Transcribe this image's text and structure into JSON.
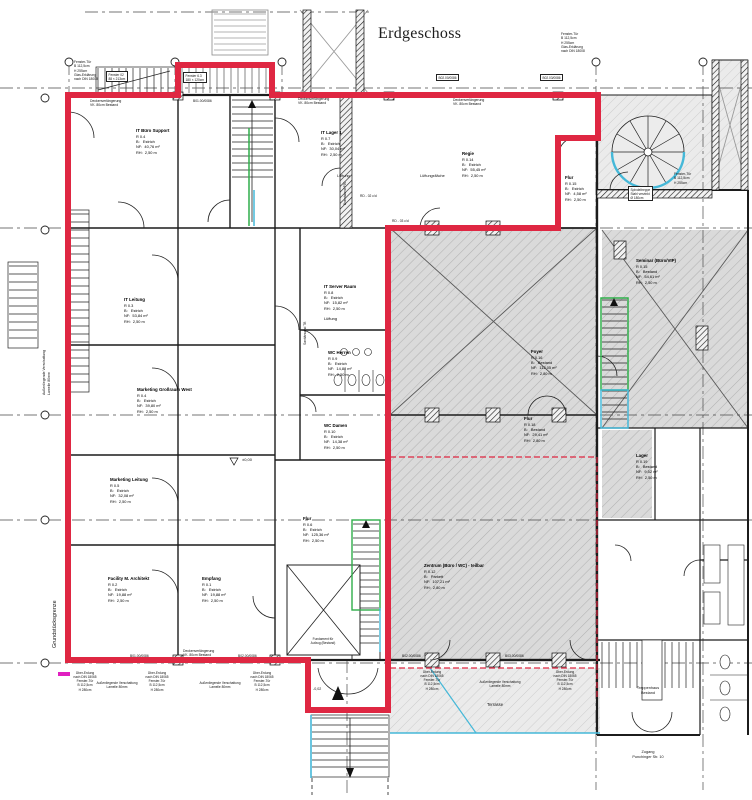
{
  "title": "Erdgeschoss",
  "colors": {
    "boundary_red": "#df2742",
    "hatch_gray": "#dadada",
    "accent_cyan": "#45b8d8",
    "accent_green": "#2fae4a",
    "accent_magenta": "#e020c0",
    "line_black": "#1c1c1c"
  },
  "rooms": [
    {
      "name": "IT Büro Support",
      "nr": "R 0.4",
      "b": "B:   Estrich",
      "nf": "NF:  40,76 m²",
      "rh": "RH:  2,50 m",
      "x": 136,
      "y": 128
    },
    {
      "name": "IT Lager 1",
      "nr": "R 0.7",
      "b": "B:   Estrich",
      "nf": "NF:  30,04 m²",
      "rh": "RH:  2,50 m",
      "x": 321,
      "y": 130
    },
    {
      "name": "Regie",
      "nr": "R 0.14",
      "b": "B:   Estrich",
      "nf": "NF:  55,45 m²",
      "rh": "RH:  2,50 m",
      "x": 462,
      "y": 151
    },
    {
      "name": "Flur",
      "nr": "R 0.15",
      "b": "B:   Estrich",
      "nf": "NF:  4,58 m²",
      "rh": "RH:  2,50 m",
      "x": 565,
      "y": 175
    },
    {
      "name": "IT Leitung",
      "nr": "R 0.3",
      "b": "B:   Estrich",
      "nf": "NF:  53,84 m²",
      "rh": "RH:  2,50 m",
      "x": 124,
      "y": 297
    },
    {
      "name": "IT Server Raum",
      "nr": "R 0.8",
      "b": "B:   Estrich",
      "nf": "NF:  15,82 m²",
      "rh": "RH:  2,50 m",
      "extra": "Lüftung",
      "x": 324,
      "y": 284
    },
    {
      "name": "WC Herren",
      "nr": "R 0.9",
      "b": "B:   Estrich",
      "nf": "NF:  14,88 m²",
      "rh": "RH:  2,50 m",
      "x": 328,
      "y": 350
    },
    {
      "name": "WC Damen",
      "nr": "R 0.10",
      "b": "B:   Estrich",
      "nf": "NF:  14,38 m²",
      "rh": "RH:  2,50 m",
      "x": 324,
      "y": 423
    },
    {
      "name": "Marketing Großraum West",
      "nr": "R 0.4",
      "b": "B:   Estrich",
      "nf": "NF:  39,80 m²",
      "rh": "RH:  2,50 m",
      "x": 137,
      "y": 387
    },
    {
      "name": "Marketing Leitung",
      "nr": "R 0.5",
      "b": "B:   Estrich",
      "nf": "NF:  32,08 m²",
      "rh": "RH:  2,50 m",
      "x": 110,
      "y": 477
    },
    {
      "name": "Flur",
      "nr": "R 0.6",
      "b": "B:   Estrich",
      "nf": "NF:  125,36 m²",
      "rh": "RH:  2,50 m",
      "x": 303,
      "y": 516
    },
    {
      "name": "Facility M. Architekt",
      "nr": "R 0.2",
      "b": "B:   Estrich",
      "nf": "NF:  19,88 m²",
      "rh": "RH:  2,50 m",
      "x": 108,
      "y": 576
    },
    {
      "name": "Empfang",
      "nr": "R 0.1",
      "b": "B:   Estrich",
      "nf": "NF:  19,88 m²",
      "rh": "RH:  2,50 m",
      "x": 202,
      "y": 576
    },
    {
      "name": "Foyer",
      "nr": "R 0.16",
      "b": "B:   Bestand",
      "nf": "NF:  112,05 m²",
      "rh": "RH:  2,80 m",
      "x": 531,
      "y": 349
    },
    {
      "name": "Flur",
      "nr": "R 0.18",
      "b": "B:   Bestand",
      "nf": "NF:  29,41 m²",
      "rh": "RH:  2,80 m",
      "x": 524,
      "y": 416
    },
    {
      "name": "Zentrum (Büro / WC) - teilbar",
      "nr": "R 0.12",
      "b": "B:   Parkett",
      "nf": "NF:  107,21 m²",
      "rh": "RH:  2,80 m",
      "x": 424,
      "y": 563
    },
    {
      "name": "Seminar (Büro/VIP)",
      "nr": "R 0.15",
      "b": "B:   Bestand",
      "nf": "NF:  54,61 m²",
      "rh": "RH:  2,50 m",
      "x": 636,
      "y": 258
    },
    {
      "name": "Lager",
      "nr": "R 0.19",
      "b": "B:   Bestand",
      "nf": "NF:  9,52 m²",
      "rh": "RH:  2,50 m",
      "x": 636,
      "y": 453
    }
  ],
  "annotations": [
    {
      "n": "grundstuecksgrenze-label",
      "t": "Grundstücksgrenze",
      "x": 52,
      "y": 648,
      "s": 5.5,
      "r": -90
    },
    {
      "n": "verschattung-left-label",
      "t": "Außenliegende Verschattung\nLamelle 80mm",
      "x": 42,
      "y": 395,
      "s": 3.5,
      "r": -90
    },
    {
      "n": "sanitaerwand-label",
      "t": "Sanitärwand TB",
      "x": 303,
      "y": 345,
      "s": 3.3,
      "r": -90
    },
    {
      "n": "brandwand-label",
      "t": "Brandwand F90",
      "x": 343,
      "y": 205,
      "s": 3.3,
      "r": -90
    },
    {
      "n": "lueftung-label",
      "t": "Lüftung",
      "x": 337,
      "y": 174,
      "s": 3.8
    },
    {
      "n": "lueftungsflaeche-label",
      "t": "Lüftungsfläche",
      "x": 420,
      "y": 174,
      "s": 3.8
    },
    {
      "n": "deckenverlaengerung-1",
      "t": "Deckenverlängerung\nVK. 80cm Bestand",
      "x": 90,
      "y": 99,
      "s": 3.4
    },
    {
      "n": "deckenverlaengerung-2",
      "t": "Deckenverlängerung\nVK. 80cm Bestand",
      "x": 298,
      "y": 97,
      "s": 3.4
    },
    {
      "n": "deckenverlaengerung-3",
      "t": "Deckenverlängerung\nVK. 80cm Bestand",
      "x": 453,
      "y": 98,
      "s": 3.4
    },
    {
      "n": "deckenverlaengerung-4",
      "t": "Deckenverlängerung\nVK. 80cm Bestand",
      "x": 183,
      "y": 649,
      "s": 3.4
    },
    {
      "n": "fenstertuer-topleft",
      "t": "Fenster-Tür\nB 112,5cm\nH 255cm\nGlas-Erklärung\nnach DIN 18008",
      "x": 74,
      "y": 60,
      "s": 3.3
    },
    {
      "n": "fenstertuer-topright",
      "t": "Fenster-Tür\nB 112,5cm\nH 255cm\nGlas-Erklärung\nnach DIN 18008",
      "x": 561,
      "y": 32,
      "s": 3.3
    },
    {
      "n": "fenstertuer-right",
      "t": "Fenster-Tür\nB 112,5cm\nH 255cm",
      "x": 674,
      "y": 172,
      "s": 3.3
    },
    {
      "n": "spindeltreppe-chip",
      "t": "Spindeltreppe\nStahl verzinkt\nØ 180cm",
      "x": 628,
      "y": 186,
      "s": 3.2,
      "b": 1
    },
    {
      "n": "fenster-chip-1",
      "t": "Fenster 02\n88 × 213cm",
      "x": 106,
      "y": 71,
      "s": 3.2,
      "b": 1
    },
    {
      "n": "fenster-chip-2",
      "t": "Fenster 6.3\n180 × 120cm",
      "x": 183,
      "y": 72,
      "s": 3.2,
      "b": 1
    },
    {
      "n": "code-top-1",
      "t": "B01.00/0086",
      "x": 193,
      "y": 99,
      "s": 3.3
    },
    {
      "n": "code-chip-2",
      "t": "B02.00/0086",
      "x": 436,
      "y": 74,
      "s": 3.2,
      "b": 1
    },
    {
      "n": "code-chip-3",
      "t": "B02.03/0086",
      "x": 540,
      "y": 74,
      "s": 3.2,
      "b": 1
    },
    {
      "n": "rd-code-1",
      "t": "RD - 02 c/d",
      "x": 360,
      "y": 194,
      "s": 3.3
    },
    {
      "n": "rd-code-2",
      "t": "RD - 03 c/d",
      "x": 392,
      "y": 219,
      "s": 3.3
    },
    {
      "n": "code-bottom-1",
      "t": "B01.00/0086",
      "x": 130,
      "y": 654,
      "s": 3.3
    },
    {
      "n": "code-bottom-2",
      "t": "B02.00/0086",
      "x": 238,
      "y": 654,
      "s": 3.3
    },
    {
      "n": "code-bottom-3",
      "t": "B02.00/0086",
      "x": 402,
      "y": 654,
      "s": 3.3
    },
    {
      "n": "code-bottom-4",
      "t": "B03.00/0086",
      "x": 505,
      "y": 654,
      "s": 3.3
    },
    {
      "n": "window-annotation-1",
      "t": "Über-Erdung\nnach DIN 18065\nFenster-Tür\nB 112,5cm\nH 280cm",
      "x": 85,
      "y": 671,
      "s": 3.2,
      "c": 1
    },
    {
      "n": "window-annotation-2",
      "t": "Über-Erdung\nnach DIN 18065\nFenster-Tür\nB 112,5cm\nH 280cm",
      "x": 157,
      "y": 671,
      "s": 3.2,
      "c": 1
    },
    {
      "n": "window-annotation-3",
      "t": "Über-Erdung\nnach DIN 18065\nFenster-Tür\nB 112,5cm\nH 280cm",
      "x": 262,
      "y": 671,
      "s": 3.2,
      "c": 1
    },
    {
      "n": "window-annotation-4",
      "t": "Über-Erdung\nnach DIN 18065\nFenster-Tür\nB 112,5cm\nH 280cm",
      "x": 432,
      "y": 670,
      "s": 3.2,
      "c": 1
    },
    {
      "n": "window-annotation-5",
      "t": "Über-Erdung\nnach DIN 18065\nFenster-Tür\nB 112,5cm\nH 280cm",
      "x": 565,
      "y": 670,
      "s": 3.2,
      "c": 1
    },
    {
      "n": "verschattung-bottom-1",
      "t": "Außenliegende Verschattung\nLamelle 80mm",
      "x": 117,
      "y": 681,
      "s": 3.2,
      "c": 1
    },
    {
      "n": "verschattung-bottom-2",
      "t": "Außenliegende Verschattung\nLamelle 80mm",
      "x": 220,
      "y": 681,
      "s": 3.2,
      "c": 1
    },
    {
      "n": "verschattung-bottom-3",
      "t": "Außenliegende Verschattung\nLamelle 80mm",
      "x": 500,
      "y": 680,
      "s": 3.2,
      "c": 1
    },
    {
      "n": "treppenhaus-label",
      "t": "Treppenhaus\nBestand",
      "x": 648,
      "y": 686,
      "s": 3.8,
      "c": 1
    },
    {
      "n": "zugang-label",
      "t": "Zugang\nPunchinger Str. 10",
      "x": 648,
      "y": 750,
      "s": 3.8,
      "c": 1
    },
    {
      "n": "terrasse-label",
      "t": "Terrasse",
      "x": 487,
      "y": 702,
      "s": 4.2
    },
    {
      "n": "level-zero-label",
      "t": "±0,00",
      "x": 242,
      "y": 457,
      "s": 4
    },
    {
      "n": "level-minus-label",
      "t": "-0,02",
      "x": 313,
      "y": 687,
      "s": 3.6
    },
    {
      "n": "aufzug-label",
      "t": "Fundament für\nAufzug (Bestand)",
      "x": 323,
      "y": 637,
      "s": 3.2,
      "c": 1
    }
  ]
}
